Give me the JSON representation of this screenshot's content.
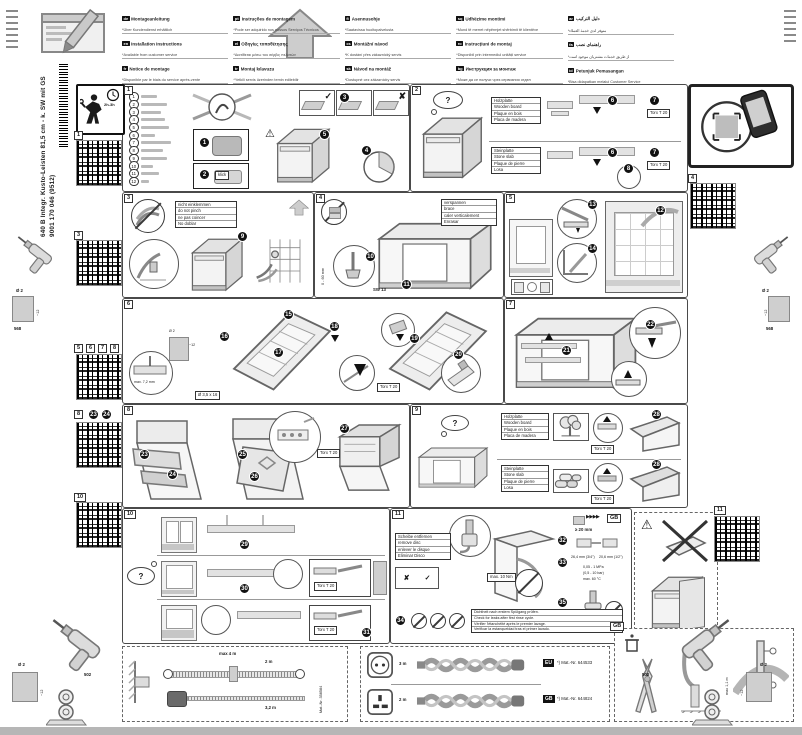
{
  "page": {
    "model": "640 B Integr. Kusto-Leisten 81,5 cm - k. SW mit GS",
    "code": "9001 170 046 (9512)"
  },
  "colors": {
    "ink": "#1a1a1a",
    "panel_border": "#4a4a4a"
  },
  "header": {
    "columns": [
      [
        {
          "code": "de",
          "title": "Montageanleitung",
          "note": "*Über Kundendienst erhältlich"
        },
        {
          "code": "en",
          "title": "Installation instructions",
          "note": "*Available from customer service"
        },
        {
          "code": "fr",
          "title": "Notice de montage",
          "note": "*Disponible par le biais du service après-vente"
        },
        {
          "code": "nl",
          "title": "Montagevoorschrift",
          "note": "*Tegen meerprijs bij de servicedienst verkrijgbaar"
        },
        {
          "code": "it",
          "title": "Istruzioni per il montaggio",
          "note": "*Disponibili presso il servizio ass. clienti"
        },
        {
          "code": "es",
          "title": "Indicaciones de montaje",
          "note": "*) Repuesto adquirible a través del Servicio de Asistencia Técnica"
        }
      ],
      [
        {
          "code": "pt",
          "title": "Instruções de montagem",
          "note": "*Pode ser adquirido nos nossos Serviços Técnicos"
        },
        {
          "code": "el",
          "title": "Οδηγίες τοποθέτησης",
          "note": "*Διατίθεται μέσω του σέρβις πελατών"
        },
        {
          "code": "tr",
          "title": "Montaj kılavuzu",
          "note": "*Yetkili servis üzerinden temin edilebilir"
        },
        {
          "code": "da",
          "title": "Monteringsvejledning",
          "note": "*Kan fås via kundeservice"
        },
        {
          "code": "no",
          "title": "Monteringsveiledning",
          "note": "*Fås hos kundeservice"
        },
        {
          "code": "sv",
          "title": "Monteringsanvisning",
          "note": "*Kan beställas hos kundservice"
        }
      ],
      [
        {
          "code": "fi",
          "title": "Asennusohje",
          "note": "*Saatavissa huoltopalvelusta"
        },
        {
          "code": "cs",
          "title": "Montážní návod",
          "note": "*K dostání přes zákaznický servis"
        },
        {
          "code": "sk",
          "title": "Návod na montáž",
          "note": "*Dostupné cez zákaznícky servis"
        },
        {
          "code": "pl",
          "title": "Instrukcja montażu",
          "note": "*Do nabycia w serwisie fabrycznym"
        },
        {
          "code": "sl",
          "title": "Navodila za montažo",
          "note": "*Na voljo pri servisni službi"
        },
        {
          "code": "hr",
          "title": "Upute za montažu",
          "note": "*Može se dobiti kod servisne službe"
        }
      ],
      [
        {
          "code": "sq",
          "title": "Udhëzime montimi",
          "note": "*Mund të merret nëpërmjet shërbimit të klientëve"
        },
        {
          "code": "ro",
          "title": "Instrucțiuni de montaj",
          "note": "*Disponibil prin intermediul unității service"
        },
        {
          "code": "bg",
          "title": "Инструкция за монтаж",
          "note": "*Може да се получи чрез сервизния отдел"
        },
        {
          "code": "uk",
          "title": "Інструкція з монтажу",
          "note": "*Можна отримати в сервісному центрі"
        },
        {
          "code": "ru",
          "title": "Инструкция по монтажу",
          "note": "*Можно получить в сервисном центре"
        },
        {
          "code": "kk",
          "title": "Монтаждау нұсқаулығы",
          "note": "*Сервис орталығы арқылы алуға болады"
        }
      ],
      [
        {
          "code": "ar",
          "title": "دليل التركيب",
          "note": "*متوفر لدى خدمة العملاء"
        },
        {
          "code": "fa",
          "title": "راهنمای نصب",
          "note": "*از طریق خدمات مشتریان موجود است"
        },
        {
          "code": "id",
          "title": "Petunjuk Pemasangan",
          "note": "*Bisa didapatkan melalui Customer Service"
        },
        {
          "code": "th",
          "title": "คู่มือการติดตั้ง",
          "note": "*ขอรับได้จากฝ่ายบริการลูกค้า"
        },
        {
          "code": "ko",
          "title": "설치 설명서",
          "note": "*고객 서비스 센터를 통해 구입 가능"
        },
        {
          "code": "zh",
          "title": "安装说明",
          "note": "*可向客户服务中心购买"
        }
      ]
    ]
  },
  "sidebar": {
    "time": "2h-3h",
    "tags": {
      "t1": "1",
      "t3": "3",
      "t5": "5",
      "t6": "6",
      "t7": "7",
      "t8": "8",
      "t8b": "8",
      "s23": "23",
      "s24": "24",
      "t10": "10",
      "t4": "4",
      "t11": "11"
    }
  },
  "drill": {
    "dia": "Ø 2",
    "depth": "~12",
    "side": "568",
    "bottom": "502"
  },
  "panels": {
    "p1": {
      "tag": "1",
      "parts": [
        "1",
        "2",
        "3",
        "4",
        "5",
        "6",
        "7",
        "8",
        "9",
        "10",
        "11",
        "12"
      ],
      "steps": {
        "s1": "1",
        "s2": "2",
        "s3": "3",
        "s4": "4",
        "s5": "5"
      },
      "klick": "klick",
      "check": "✓",
      "cross": "✘",
      "warn": "⚠"
    },
    "p2": {
      "tag": "2",
      "q": "?",
      "torx": "Torx T 20",
      "wood": {
        "l1": "Holzplatte",
        "l2": "Wooden board",
        "l3": "Plaque en bois",
        "l4": "Placa de madera"
      },
      "stone": {
        "l1": "Steinplatte",
        "l2": "Stone slab",
        "l3": "Plaque de pierre",
        "l4": "Losa"
      },
      "steps": {
        "s6": "6",
        "s7": "7",
        "s8": "8"
      }
    },
    "p3": {
      "tag": "3",
      "note": {
        "l1": "nicht einklemmen",
        "l2": "do not pinch",
        "l3": "ne pas coincer",
        "l4": "No doblar"
      },
      "steps": {
        "s9": "9"
      }
    },
    "p4": {
      "tag": "4",
      "note": {
        "l1": "verspannen",
        "l2": "brace",
        "l3": "caler verticalement",
        "l4": "Enrasar"
      },
      "tool": "SW 13",
      "range": "0 - 60 mm",
      "steps": {
        "s10": "10",
        "s11": "11"
      }
    },
    "p5": {
      "tag": "5",
      "steps": {
        "s12": "12",
        "s13": "13",
        "s14": "14"
      }
    },
    "p6": {
      "tag": "6",
      "depth_note": "max. 7,2 mm",
      "drill_dia": "Ø 2",
      "drill_depth": "~12",
      "screw": "Ø 3,5 x 16",
      "torx": "Torx T 20",
      "steps": {
        "s15": "15",
        "s16": "16",
        "s17": "17",
        "s18": "18",
        "s19": "19",
        "s20": "20"
      }
    },
    "p7": {
      "tag": "7",
      "steps": {
        "s21": "21",
        "s22": "22"
      }
    },
    "p8": {
      "tag": "8",
      "torx": "Torx T 20",
      "steps": {
        "s23": "23",
        "s24": "24",
        "s25": "25",
        "s26": "26",
        "s27": "27"
      }
    },
    "p9": {
      "tag": "9",
      "q": "?",
      "torx": "Torx T 20",
      "wood": {
        "l1": "Holzplatte",
        "l2": "Wooden board",
        "l3": "Plaque en bois",
        "l4": "Placa de madera"
      },
      "stone": {
        "l1": "Steinplatte",
        "l2": "Stone slab",
        "l3": "Plaque de pierre",
        "l4": "Losa"
      },
      "steps": {
        "a": "28",
        "b": "28"
      }
    },
    "p10": {
      "tag": "10",
      "q": "?",
      "torx": "Torx T 20",
      "steps": {
        "s29": "29",
        "s30": "30",
        "s31": "31"
      }
    },
    "p11": {
      "tag": "11",
      "torque": "max. 10 Nm",
      "gb": "GB",
      "arrows": "▶▶▶▶",
      "clearance": "≥ 20 mm",
      "fit_a": "26,4 mm (3/4\")",
      "fit_b": "20,6 mm (1/2\")",
      "pressure1": "0,05 - 1 MPa",
      "pressure2": "(0,5 - 10 bar)",
      "temp": "max. 60 °C",
      "check": "✓",
      "cross": "✘",
      "warn": "⚠",
      "disc": {
        "l1": "Scheibe entfernen",
        "l2": "remove disc",
        "l3": "enlever le disque",
        "l4": "Eliminar Disco"
      },
      "leak": {
        "l1": "Dichtheit nach erstem Spülgang prüfen.",
        "l2": "Check for leaks after first rinse cycle.",
        "l3": "Vérifier l'étanchéité après le premier lavage.",
        "l4": "Verificar la estanqueidad tras el primer lavado."
      },
      "steps": {
        "s32": "32",
        "s33": "33",
        "s34": "34",
        "s35": "35"
      }
    },
    "warnbox": {
      "warn": "⚠"
    }
  },
  "bottom": {
    "hose": {
      "max": "max 4 m",
      "l1": "2 m",
      "l2": "3,2 m",
      "mat": "Mat.-Nr. 358584"
    },
    "cords": {
      "r1_len": "3 m",
      "r1_tag": "EU",
      "r1_mat": "*) Mat.-Nr. 644533",
      "r2_len": "2 m",
      "r2_tag": "GB",
      "r2_mat": "*) Mat.-Nr. 644824"
    },
    "gb": {
      "tag": "GB",
      "drain": "max 1,1 m"
    }
  }
}
